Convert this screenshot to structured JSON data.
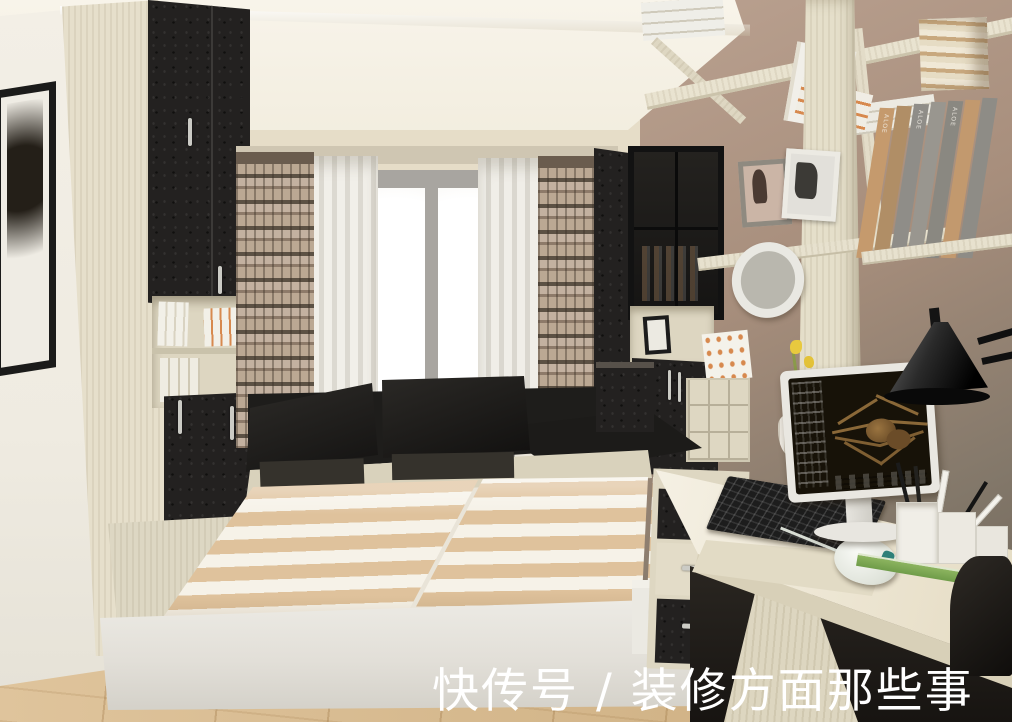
{
  "scene": {
    "description": "3D interior rendering of a small bedroom-study: tatami storage bed with lifted lids, black-and-cream wardrobe, bright window with plaid and sheer curtains, taupe wall with cream shelving, computer desk with monitor showing a tarantula wallpaper, black desk lamp and office chair"
  },
  "watermark": {
    "text": "快传号 / 装修方面那些事",
    "color": "#ffffff"
  },
  "bookshelf": {
    "spine_label": "ALOE"
  },
  "palette": {
    "ceiling": "#f7f3e8",
    "left_wall": "#f1ede3",
    "right_wall_top": "#b79e90",
    "right_wall_bottom": "#675d52",
    "wood_light": "#e7e1cd",
    "wood_shadow": "#d6cfb9",
    "black_furniture": "#211f1d",
    "mattress_tan": "#dfc29c",
    "mattress_cream": "#f6f2e8",
    "floor": "#d8b786",
    "window_glow": "#ffffff",
    "curtain_sheer": "#eceae4",
    "curtain_plaid_base": "#b3a090",
    "curtain_plaid_dark": "#5f5447",
    "desk_wood": "#efe8d4",
    "lamp_black": "#161616",
    "mouse_white": "#eef2ea",
    "ruler_green": "#7fae57",
    "accent_book_orange": "#d7894e"
  }
}
